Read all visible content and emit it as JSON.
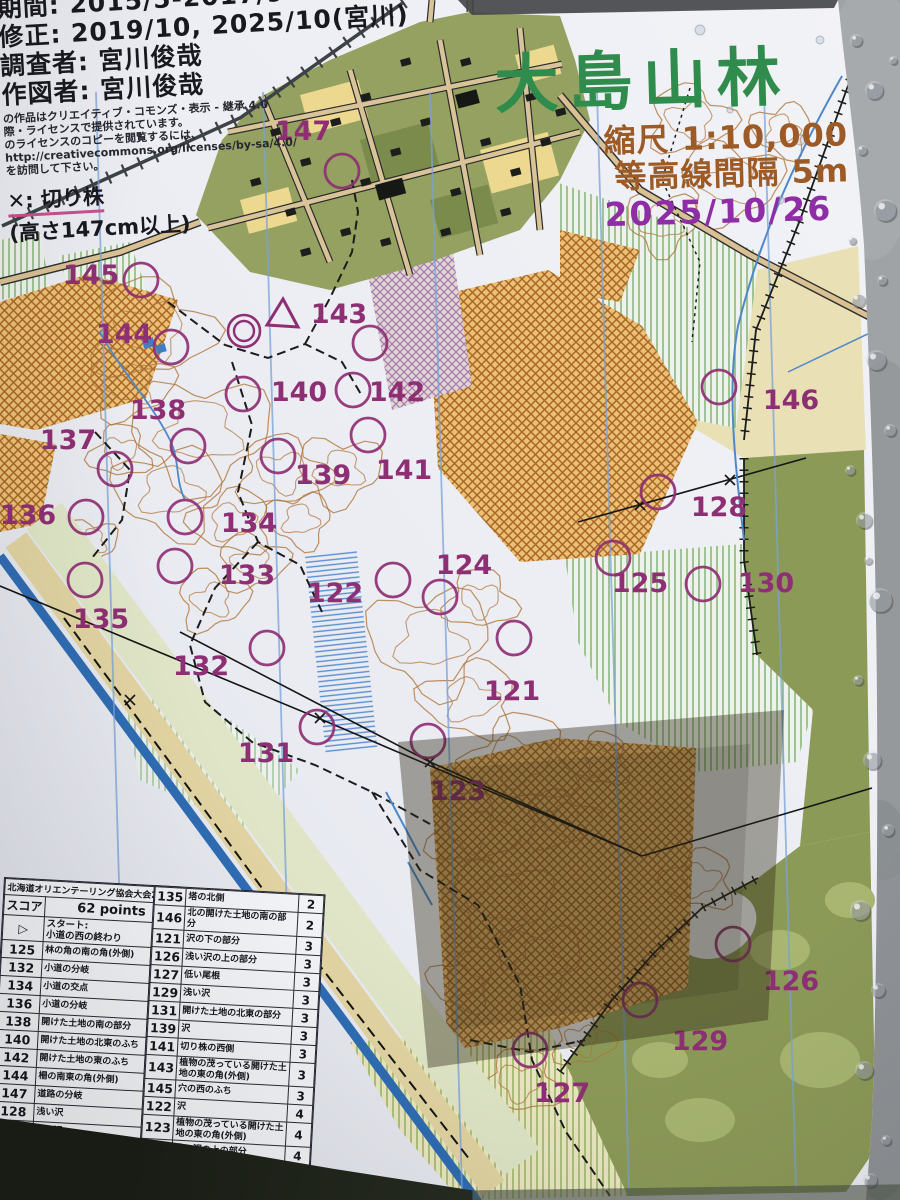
{
  "top_left_info": {
    "period_line": "期間: 2015/5-2017/9",
    "revision_line": "修正: 2019/10, 2025/10(宮川)",
    "surveyor_line": "調査者: 宮川俊哉",
    "drafter_line": "作図者: 宮川俊哉",
    "cc_small_lines": [
      "の作品はクリエイティブ・コモンズ・表示 - 継承 4.0",
      "際・ライセンスで提供されています。",
      "のライセンスのコピーを閲覧するには、",
      "http://creativecommons.org/licenses/by-sa/4.0/",
      "を訪問して下さい。"
    ],
    "cc_badge": {
      "cc": "CC",
      "by": "BY",
      "sa": "SA"
    },
    "stump_legend": "✕: 切り株",
    "stump_note": "(高さ147cm以上)"
  },
  "title_block": {
    "title": "大島山林",
    "scale": "縮尺 1:10,000",
    "contour_interval": "等高線間隔 5m",
    "date": "2025/10/26",
    "title_color": "#2f8c4c",
    "scale_color": "#9c5a26",
    "date_color": "#8e2da6"
  },
  "map": {
    "control_color": "#8e2f74",
    "circle_radius": 17,
    "controls": [
      {
        "num": "121",
        "cx": 514,
        "cy": 638,
        "lx": 512,
        "ly": 700
      },
      {
        "num": "122",
        "cx": 393,
        "cy": 580,
        "lx": 335,
        "ly": 602
      },
      {
        "num": "123",
        "cx": 428,
        "cy": 741,
        "lx": 458,
        "ly": 800
      },
      {
        "num": "124",
        "cx": 440,
        "cy": 597,
        "lx": 464,
        "ly": 574
      },
      {
        "num": "125",
        "cx": 613,
        "cy": 558,
        "lx": 640,
        "ly": 592
      },
      {
        "num": "126",
        "cx": 733,
        "cy": 944,
        "lx": 791,
        "ly": 990
      },
      {
        "num": "127",
        "cx": 530,
        "cy": 1050,
        "lx": 562,
        "ly": 1102
      },
      {
        "num": "128",
        "cx": 658,
        "cy": 492,
        "lx": 719,
        "ly": 516
      },
      {
        "num": "129",
        "cx": 640,
        "cy": 1000,
        "lx": 700,
        "ly": 1050
      },
      {
        "num": "130",
        "cx": 703,
        "cy": 584,
        "lx": 766,
        "ly": 592
      },
      {
        "num": "131",
        "cx": 317,
        "cy": 727,
        "lx": 266,
        "ly": 762
      },
      {
        "num": "132",
        "cx": 267,
        "cy": 648,
        "lx": 201,
        "ly": 675
      },
      {
        "num": "133",
        "cx": 175,
        "cy": 566,
        "lx": 247,
        "ly": 584
      },
      {
        "num": "134",
        "cx": 185,
        "cy": 517,
        "lx": 249,
        "ly": 532
      },
      {
        "num": "135",
        "cx": 85,
        "cy": 580,
        "lx": 101,
        "ly": 628
      },
      {
        "num": "136",
        "cx": 86,
        "cy": 517,
        "lx": 28,
        "ly": 524
      },
      {
        "num": "137",
        "cx": 115,
        "cy": 469,
        "lx": 68,
        "ly": 449
      },
      {
        "num": "138",
        "cx": 188,
        "cy": 446,
        "lx": 158,
        "ly": 419
      },
      {
        "num": "139",
        "cx": 278,
        "cy": 456,
        "lx": 323,
        "ly": 484
      },
      {
        "num": "140",
        "cx": 243,
        "cy": 394,
        "lx": 299,
        "ly": 401
      },
      {
        "num": "141",
        "cx": 368,
        "cy": 435,
        "lx": 404,
        "ly": 479
      },
      {
        "num": "142",
        "cx": 353,
        "cy": 390,
        "lx": 397,
        "ly": 401
      },
      {
        "num": "143",
        "cx": 370,
        "cy": 343,
        "lx": 339,
        "ly": 323
      },
      {
        "num": "144",
        "cx": 171,
        "cy": 347,
        "lx": 124,
        "ly": 343
      },
      {
        "num": "145",
        "cx": 141,
        "cy": 280,
        "lx": 91,
        "ly": 284
      },
      {
        "num": "146",
        "cx": 719,
        "cy": 387,
        "lx": 791,
        "ly": 409
      },
      {
        "num": "147",
        "cx": 342,
        "cy": 171,
        "lx": 303,
        "ly": 140
      }
    ],
    "start": {
      "x": 283,
      "y": 316
    },
    "finish": {
      "x": 244,
      "y": 331
    }
  },
  "score_table": {
    "event_title": "北海道オリエンテーリング協会大会2025",
    "score_label": "スコア",
    "points_total": "62 points",
    "start_symbol": "▷",
    "start_label": "スタート:",
    "start_desc": "小道の西の終わり",
    "left_rows": [
      {
        "num": "125",
        "desc": "林の角の南の角(外側)",
        "pts": "1"
      },
      {
        "num": "132",
        "desc": "小道の分岐",
        "pts": "1"
      },
      {
        "num": "134",
        "desc": "小道の交点",
        "pts": "1"
      },
      {
        "num": "136",
        "desc": "小道の分岐",
        "pts": "1"
      },
      {
        "num": "138",
        "desc": "開けた土地の南の部分",
        "pts": "1"
      },
      {
        "num": "140",
        "desc": "開けた土地の北東のふち",
        "pts": "1"
      },
      {
        "num": "142",
        "desc": "開けた土地の東のふち",
        "pts": "1"
      },
      {
        "num": "144",
        "desc": "柵の南東の角(外側)",
        "pts": "1"
      },
      {
        "num": "147",
        "desc": "道路の分岐",
        "pts": "1"
      },
      {
        "num": "128",
        "desc": "浅い沢",
        "pts": "1"
      },
      {
        "num": "130",
        "desc": "浅い沢",
        "pts": "2"
      },
      {
        "num": "133",
        "desc": "沢の分岐",
        "pts": "2"
      },
      {
        "num": "",
        "desc": "",
        "pts": "2"
      }
    ],
    "right_rows": [
      {
        "num": "135",
        "desc": "塔の北側",
        "pts": "2"
      },
      {
        "num": "146",
        "desc": "北の開けた土地の南の部分",
        "pts": "2"
      },
      {
        "num": "121",
        "desc": "沢の下の部分",
        "pts": "3"
      },
      {
        "num": "126",
        "desc": "浅い沢の上の部分",
        "pts": "3"
      },
      {
        "num": "127",
        "desc": "低い尾根",
        "pts": "3"
      },
      {
        "num": "129",
        "desc": "浅い沢",
        "pts": "3"
      },
      {
        "num": "131",
        "desc": "開けた土地の北東の部分",
        "pts": "3"
      },
      {
        "num": "139",
        "desc": "沢",
        "pts": "3"
      },
      {
        "num": "141",
        "desc": "切り株の西側",
        "pts": "3"
      },
      {
        "num": "143",
        "desc": "植物の茂っている開けた土地の東の角(外側)",
        "pts": "3"
      },
      {
        "num": "145",
        "desc": "穴の西のふち",
        "pts": "3"
      },
      {
        "num": "122",
        "desc": "沢",
        "pts": "4"
      },
      {
        "num": "123",
        "desc": "植物の茂っている開けた土地の東の角(外側)",
        "pts": "4"
      },
      {
        "num": "124",
        "desc": "浅い沢の上の部分",
        "pts": "4"
      },
      {
        "num": "137",
        "desc": "南西のクリアリング",
        "pts": "4"
      }
    ]
  }
}
